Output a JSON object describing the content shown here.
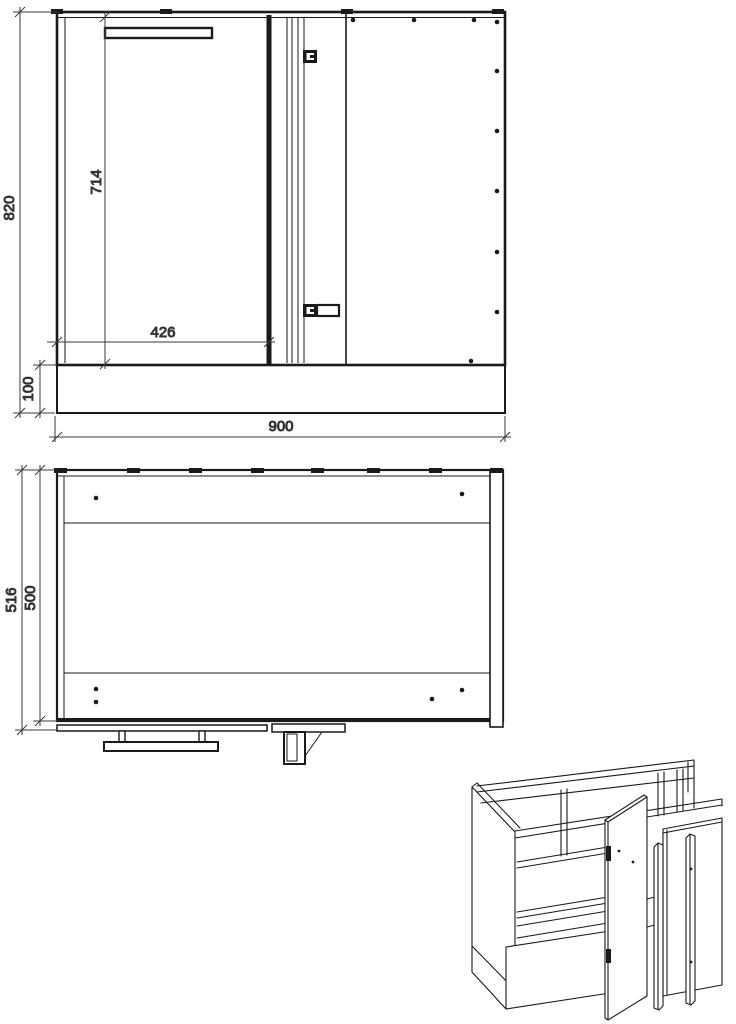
{
  "colors": {
    "line": "#1a1a1a",
    "dimension_line": "#3a3a3a",
    "background": "#ffffff"
  },
  "front_view": {
    "dim_total_height": "820",
    "dim_plinth_height": "100",
    "dim_door_height": "714",
    "dim_door_width": "426",
    "dim_total_width": "900"
  },
  "top_view": {
    "dim_total_depth": "516",
    "dim_carcass_depth": "500"
  }
}
